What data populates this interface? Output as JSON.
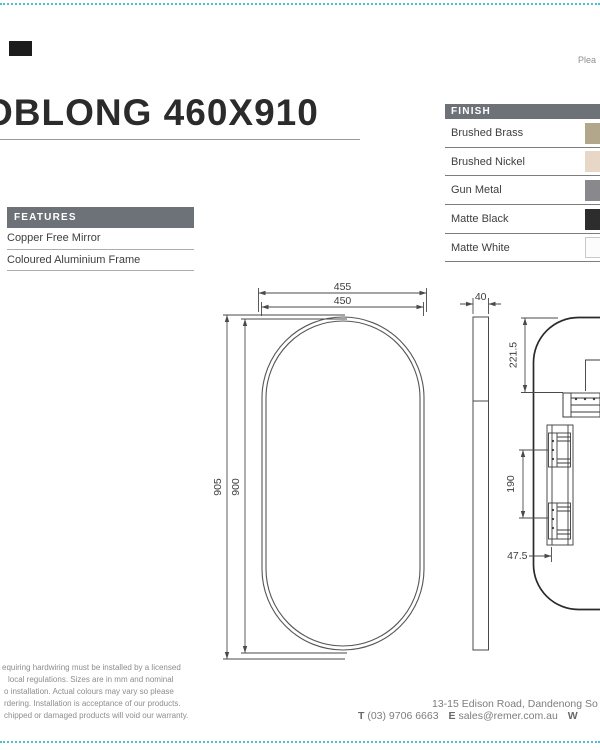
{
  "page": {
    "title": "OBLONG 460X910",
    "top_right_note": "Plea",
    "badge_color": "#1c1c1c",
    "accent_dotted_color": "#4fc0cf",
    "section_header_bg": "#6d7278"
  },
  "features": {
    "header": "FEATURES",
    "items": [
      "Copper Free Mirror",
      "Coloured Aluminium Frame"
    ]
  },
  "finish": {
    "header": "FINISH",
    "options": [
      {
        "label": "Brushed Brass",
        "color": "#b3a78b"
      },
      {
        "label": "Brushed Nickel",
        "color": "#e8d7c6"
      },
      {
        "label": "Gun Metal",
        "color": "#88888d"
      },
      {
        "label": "Matte Black",
        "color": "#2d2d2d"
      },
      {
        "label": "Matte White",
        "color": "#fcfcfc"
      }
    ]
  },
  "drawing": {
    "front_view": {
      "width_outer": "455",
      "width_inner": "450",
      "height_outer": "905",
      "height_inner": "900"
    },
    "side_view": {
      "depth": "40"
    },
    "rear_view": {
      "top_bracket_offset": "221.5",
      "bracket_hole_spacing": "190",
      "bracket_edge_offset": "47.5"
    }
  },
  "disclaimer": {
    "lines": [
      "equiring hardwiring must be installed by a licensed",
      "local regulations. Sizes are in mm and nominal",
      "o installation. Actual colours may vary so please",
      "rdering. Installation is acceptance of our products.",
      "chipped or damaged products will void our warranty."
    ]
  },
  "contact": {
    "address_line": "13-15 Edison Road, Dandenong So",
    "phone_label": "T",
    "phone": "(03) 9706 6663",
    "email_label": "E",
    "email": "sales@remer.com.au",
    "web_label": "W"
  }
}
